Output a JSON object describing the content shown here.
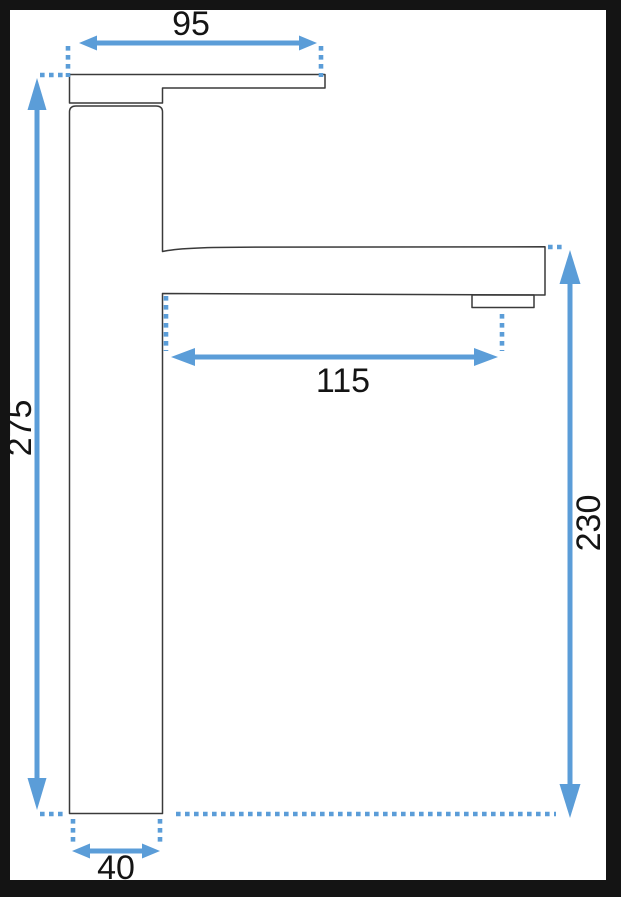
{
  "diagram": {
    "type": "technical dimension drawing",
    "subject": "tall single-lever basin faucet, side profile",
    "dimensions": {
      "top_width": "95",
      "overall_height": "275",
      "spout_reach": "115",
      "spout_height": "230",
      "base_width": "40"
    }
  },
  "colors": {
    "annotation-blue": "#5b9dd8",
    "drawing-line": "#3a3a3a",
    "label-text": "#141414",
    "frame-black": "#141414",
    "background": "#ffffff"
  }
}
